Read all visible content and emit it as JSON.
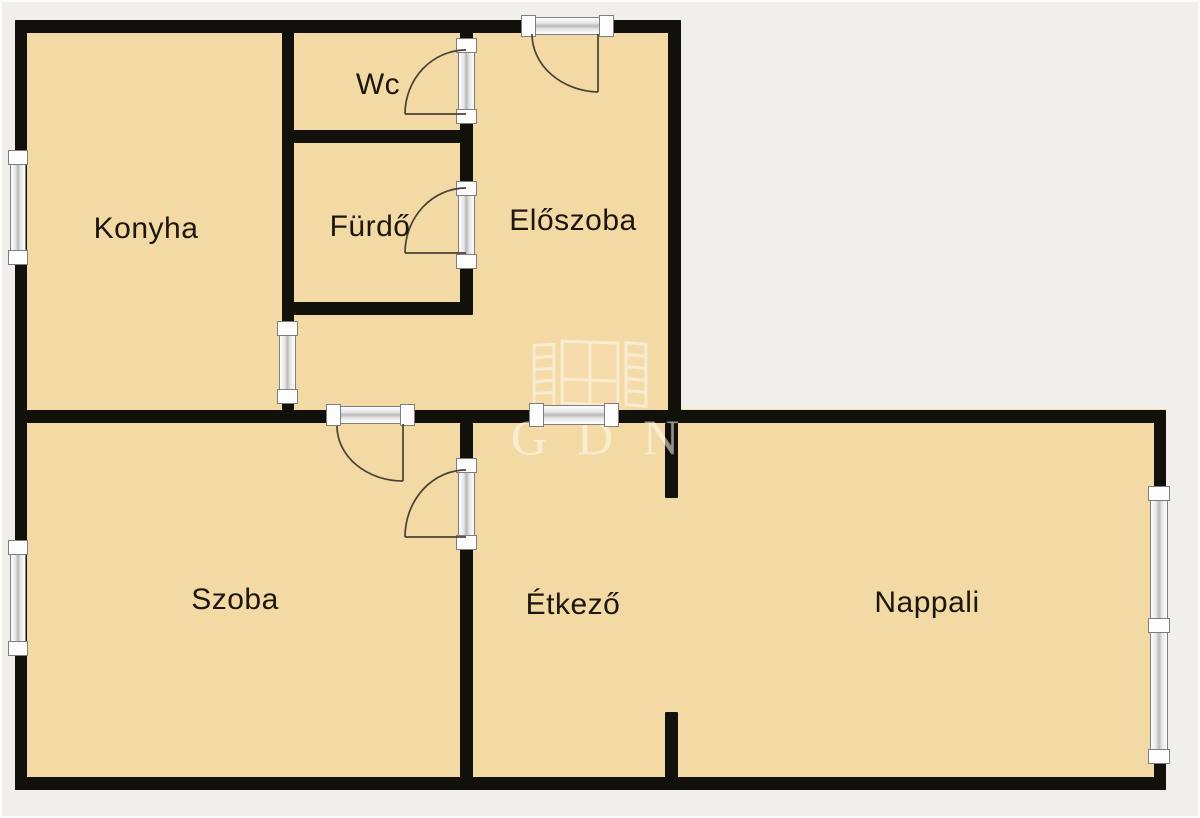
{
  "floorplan": {
    "colors": {
      "background": "#f1efeb",
      "room_fill": "#f3d9a4",
      "wall": "#12100a",
      "door_arc": "#4a4036",
      "label": "#1c160e",
      "watermark": "#fffcf3"
    },
    "rooms": [
      {
        "id": "konyha",
        "label": "Konyha"
      },
      {
        "id": "wc",
        "label": "Wc"
      },
      {
        "id": "furdo",
        "label": "Fürdő"
      },
      {
        "id": "eloszoba",
        "label": "Előszoba"
      },
      {
        "id": "szoba",
        "label": "Szoba"
      },
      {
        "id": "etkezo",
        "label": "Étkező"
      },
      {
        "id": "nappali",
        "label": "Nappali"
      }
    ],
    "watermark": {
      "text": "GDN"
    },
    "symbols": {
      "windows": [
        "window-konyha-left",
        "window-szoba-left",
        "window-konyha-pass",
        "window-middle-wall",
        "window-nappali-right-double"
      ],
      "doors": [
        "entry-door",
        "wc-door",
        "furdo-door",
        "szoba-door",
        "etkezo-door"
      ]
    }
  }
}
